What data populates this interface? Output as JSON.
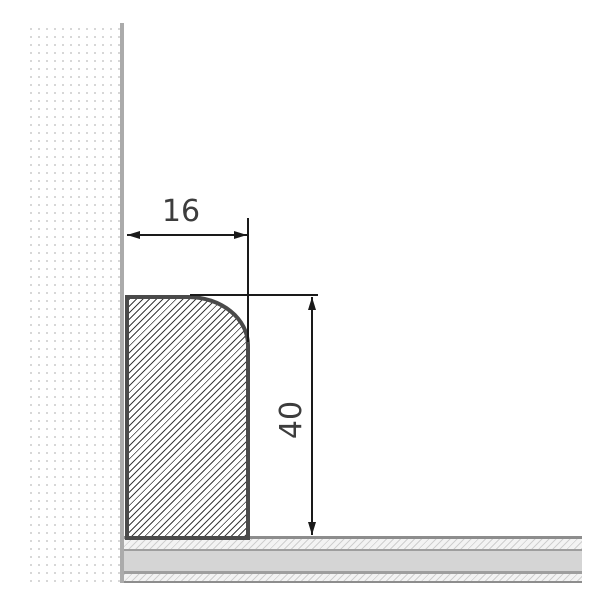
{
  "diagram": {
    "kind": "skirting-board-cross-section",
    "dimensions": {
      "width": {
        "label": "16"
      },
      "height": {
        "label": "40"
      }
    },
    "parts": {
      "wall": "dotted wall surface",
      "floor": "layered floor build-up",
      "profile": "hatched skirting profile with rounded top-right corner"
    },
    "colors": {
      "profile_border": "#4a4a4a",
      "profile_hatch": "#3c3c3c",
      "wall_dots": "#d7d7d7",
      "wall_edge_line": "#ababab",
      "floor_border": "#8d8d8d",
      "floor_inner_lines": "#9e9e9e",
      "floor_core": "#d5d5d5",
      "floor_hatch": "#cfcfcf",
      "dimension_lines": "#1a1a1a",
      "dimension_text": "#3d3d3d",
      "background": "#ffffff"
    }
  }
}
